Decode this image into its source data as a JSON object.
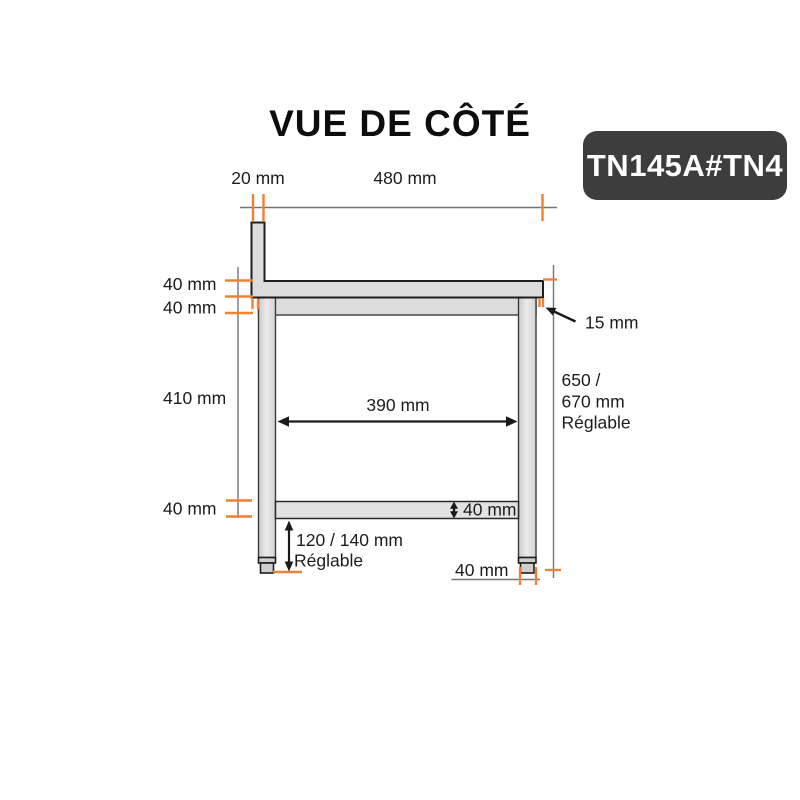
{
  "title": "VUE DE CÔTÉ",
  "product_code": "TN145A#TN4",
  "colors": {
    "accent": "#EF8136",
    "structure_fill": "#DCDCDC",
    "structure_stroke": "#2A2A2A",
    "badge_background": "#3D3D3D",
    "badge_text": "#FFFFFF",
    "dimension_line": "#757575",
    "label_text": "#1C1C1C"
  },
  "dimensions": {
    "backsplash_thickness": "20 mm",
    "top_width": "480 mm",
    "worktop_thickness": "40 mm",
    "frame_rail_height": "40 mm",
    "leg_clear_height": "410 mm",
    "shelf_height": "40 mm",
    "inner_width": "390 mm",
    "shelf_thickness": "40 mm",
    "foot_adjust_range": "120 / 140 mm",
    "foot_adjust_note": "Réglable",
    "worktop_overhang": "15 mm",
    "total_height_part1": "650 /",
    "total_height_part2": "670 mm",
    "total_height_note": "Réglable",
    "foot_width": "40 mm"
  }
}
